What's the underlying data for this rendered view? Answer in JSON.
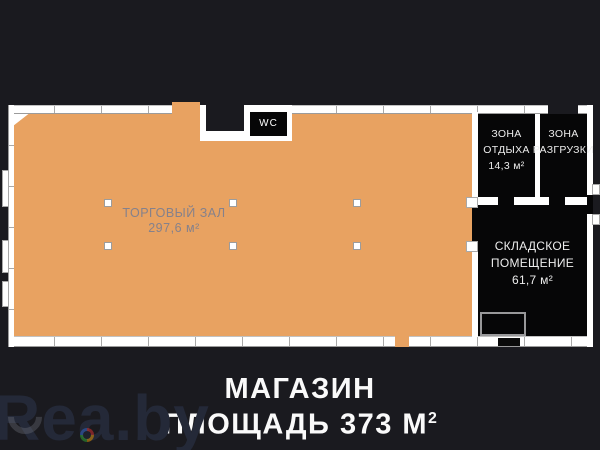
{
  "plan": {
    "wc_label": "WC",
    "trade_hall": {
      "name": "ТОРГОВЫЙ ЗАЛ",
      "area": "297,6 м²"
    },
    "rest_zone": {
      "name_line1": "ЗОНА",
      "name_line2": "ОТДЫХА",
      "area": "14,3 м²"
    },
    "unloading_zone": {
      "name_line1": "ЗОНА",
      "name_line2": "РАЗГРУЗКИ"
    },
    "storage": {
      "name_line1": "СКЛАДСКОЕ",
      "name_line2": "ПОМЕЩЕНИЕ",
      "area": "61,7 м²"
    }
  },
  "caption": {
    "line1": "МАГАЗИН",
    "line2_text": "ПЛОЩАДЬ 373 М",
    "line2_sup": "2"
  },
  "watermark": {
    "text": "Rea.by"
  },
  "colors": {
    "bg": "#1a1a1f",
    "room": "#060607",
    "floor": "#e8a261",
    "wall": "#ffffff",
    "tick": "#a9a9a9",
    "hall_text": "#85818b",
    "room_text": "#ededed",
    "caption": "#fafafa",
    "watermark": "#242938"
  }
}
